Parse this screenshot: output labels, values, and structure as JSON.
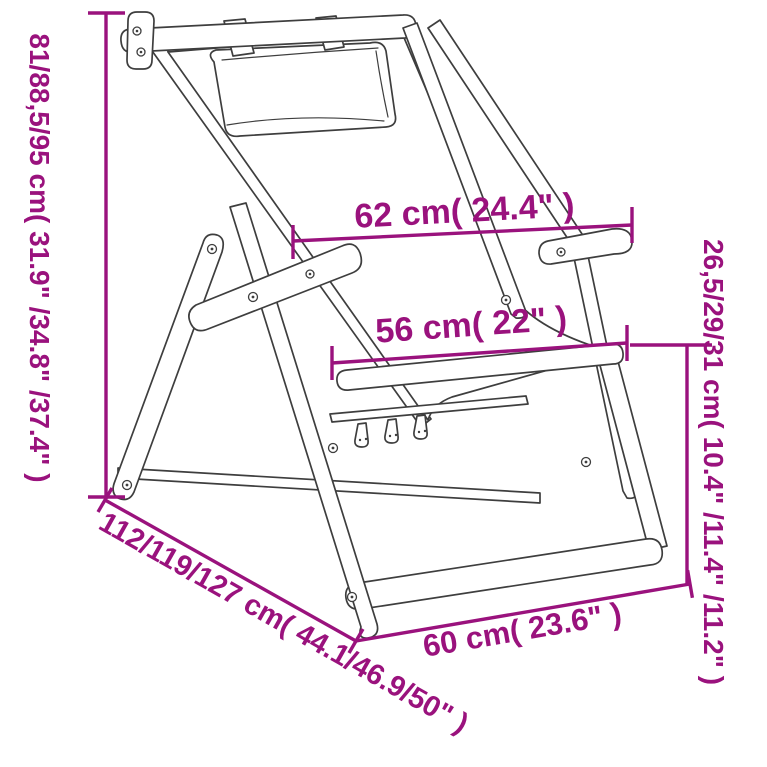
{
  "figure": {
    "type": "product-dimension-diagram",
    "subject": "folding wooden deck chair with headrest pillow, line drawing",
    "accent_color": "#9A127D",
    "line_color": "#3E3E3E",
    "background_color": "#FFFFFF"
  },
  "dimensions": {
    "height": {
      "label": "81/88,5/95 cm( 31.9\" /34.8\" /37.4\" )",
      "orientation": "vertical-left"
    },
    "top_width": {
      "label": "62 cm( 24.4\" )",
      "orientation": "horizontal"
    },
    "seat_width": {
      "label": "56 cm( 22\" )",
      "orientation": "horizontal"
    },
    "seat_height": {
      "label": "26,5/29/31 cm( 10.4\" /11.4\" /11.2\" )",
      "orientation": "vertical-right"
    },
    "depth": {
      "label": "112/119/127 cm( 44.1/46.9/50\" )",
      "orientation": "diagonal"
    },
    "bottom_width": {
      "label": "60 cm( 23.6\" )",
      "orientation": "horizontal"
    }
  }
}
